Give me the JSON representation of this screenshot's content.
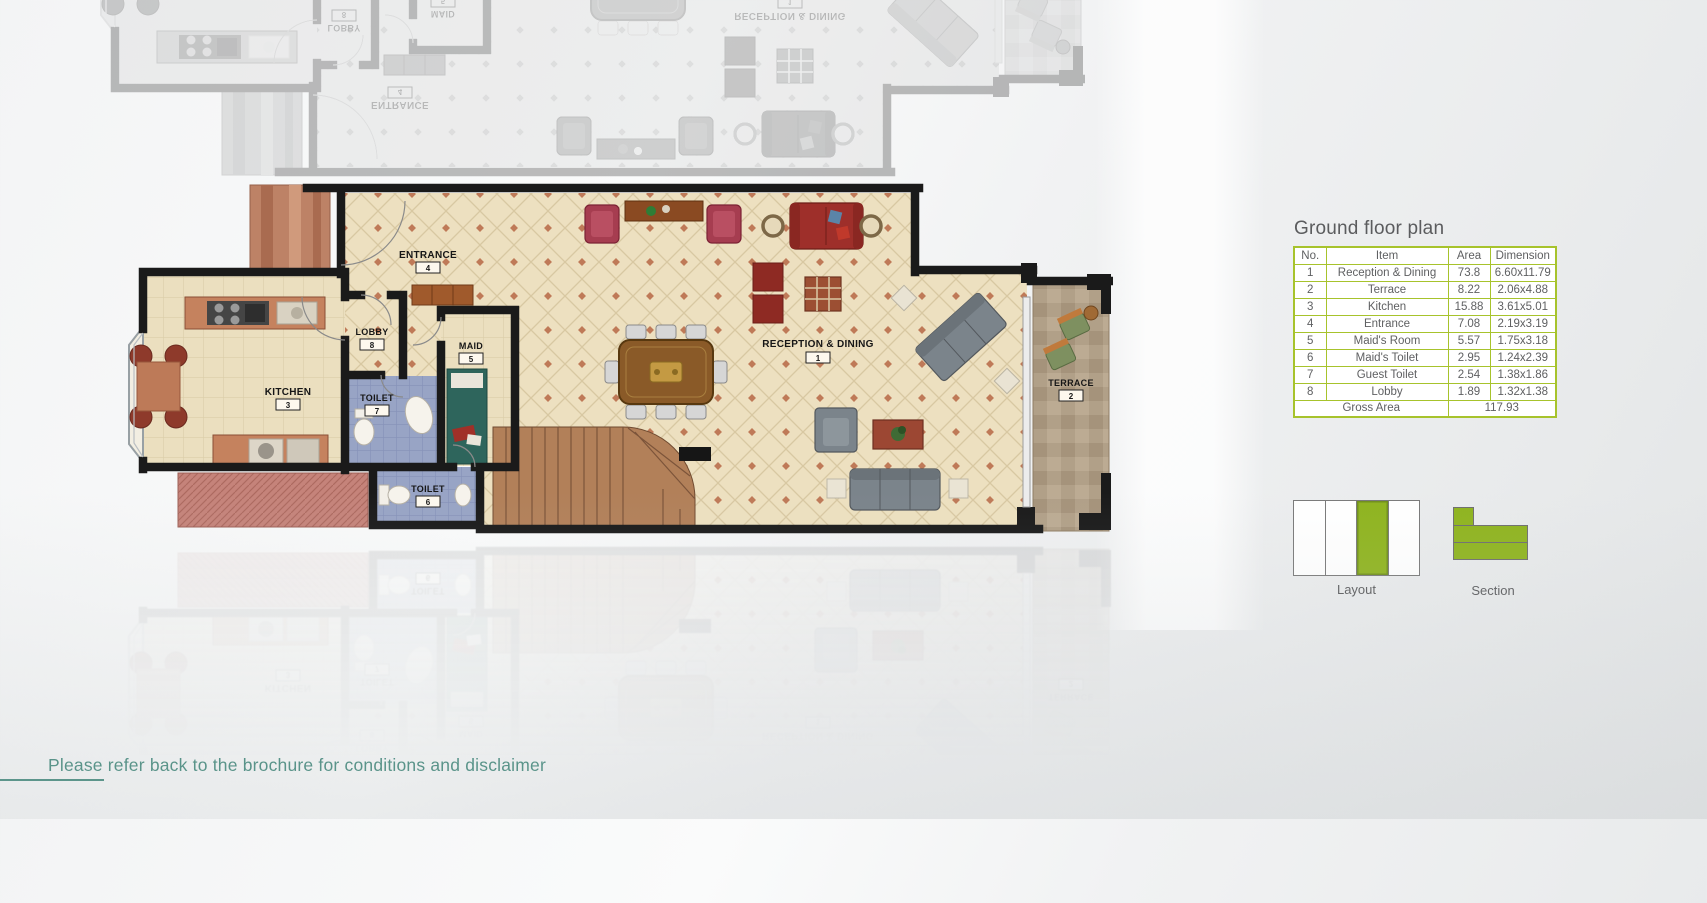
{
  "page": {
    "footer": {
      "disclaimer": "Please refer back to the brochure for conditions and disclaimer"
    }
  },
  "floor_plan": {
    "rooms": {
      "reception": {
        "label": "RECEPTION & DINING",
        "number": "1"
      },
      "terrace": {
        "label": "TERRACE",
        "number": "2"
      },
      "kitchen": {
        "label": "KITCHEN",
        "number": "3"
      },
      "entrance": {
        "label": "ENTRANCE",
        "number": "4"
      },
      "maid": {
        "label": "MAID",
        "number": "5"
      },
      "maid_toilet": {
        "label": "TOILET",
        "number": "6"
      },
      "guest_toilet": {
        "label": "TOILET",
        "number": "7"
      },
      "lobby": {
        "label": "LOBBY",
        "number": "8"
      }
    }
  },
  "panel": {
    "title": "Ground floor plan",
    "table": {
      "headers": [
        "No.",
        "Item",
        "Area",
        "Dimension"
      ],
      "rows": [
        [
          "1",
          "Reception & Dining",
          "73.8",
          "6.60x11.79"
        ],
        [
          "2",
          "Terrace",
          "8.22",
          "2.06x4.88"
        ],
        [
          "3",
          "Kitchen",
          "15.88",
          "3.61x5.01"
        ],
        [
          "4",
          "Entrance",
          "7.08",
          "2.19x3.19"
        ],
        [
          "5",
          "Maid's Room",
          "5.57",
          "1.75x3.18"
        ],
        [
          "6",
          "Maid's Toilet",
          "2.95",
          "1.24x2.39"
        ],
        [
          "7",
          "Guest Toilet",
          "2.54",
          "1.38x1.86"
        ],
        [
          "8",
          "Lobby",
          "1.89",
          "1.32x1.38"
        ]
      ],
      "footer_label": "Gross Area",
      "footer_value": "117.93"
    },
    "diagrams": {
      "layout_label": "Layout",
      "section_label": "Section",
      "layout_cells": 4,
      "layout_highlighted": 3
    }
  },
  "colors": {
    "accent_green": "#8fb41f",
    "table_border_green": "#a7c32c",
    "footer_teal": "#2b7b6c",
    "title_gray": "#5b5c5e",
    "wall_black": "#1a1a1a",
    "floor_cream": "#ede0c0"
  }
}
